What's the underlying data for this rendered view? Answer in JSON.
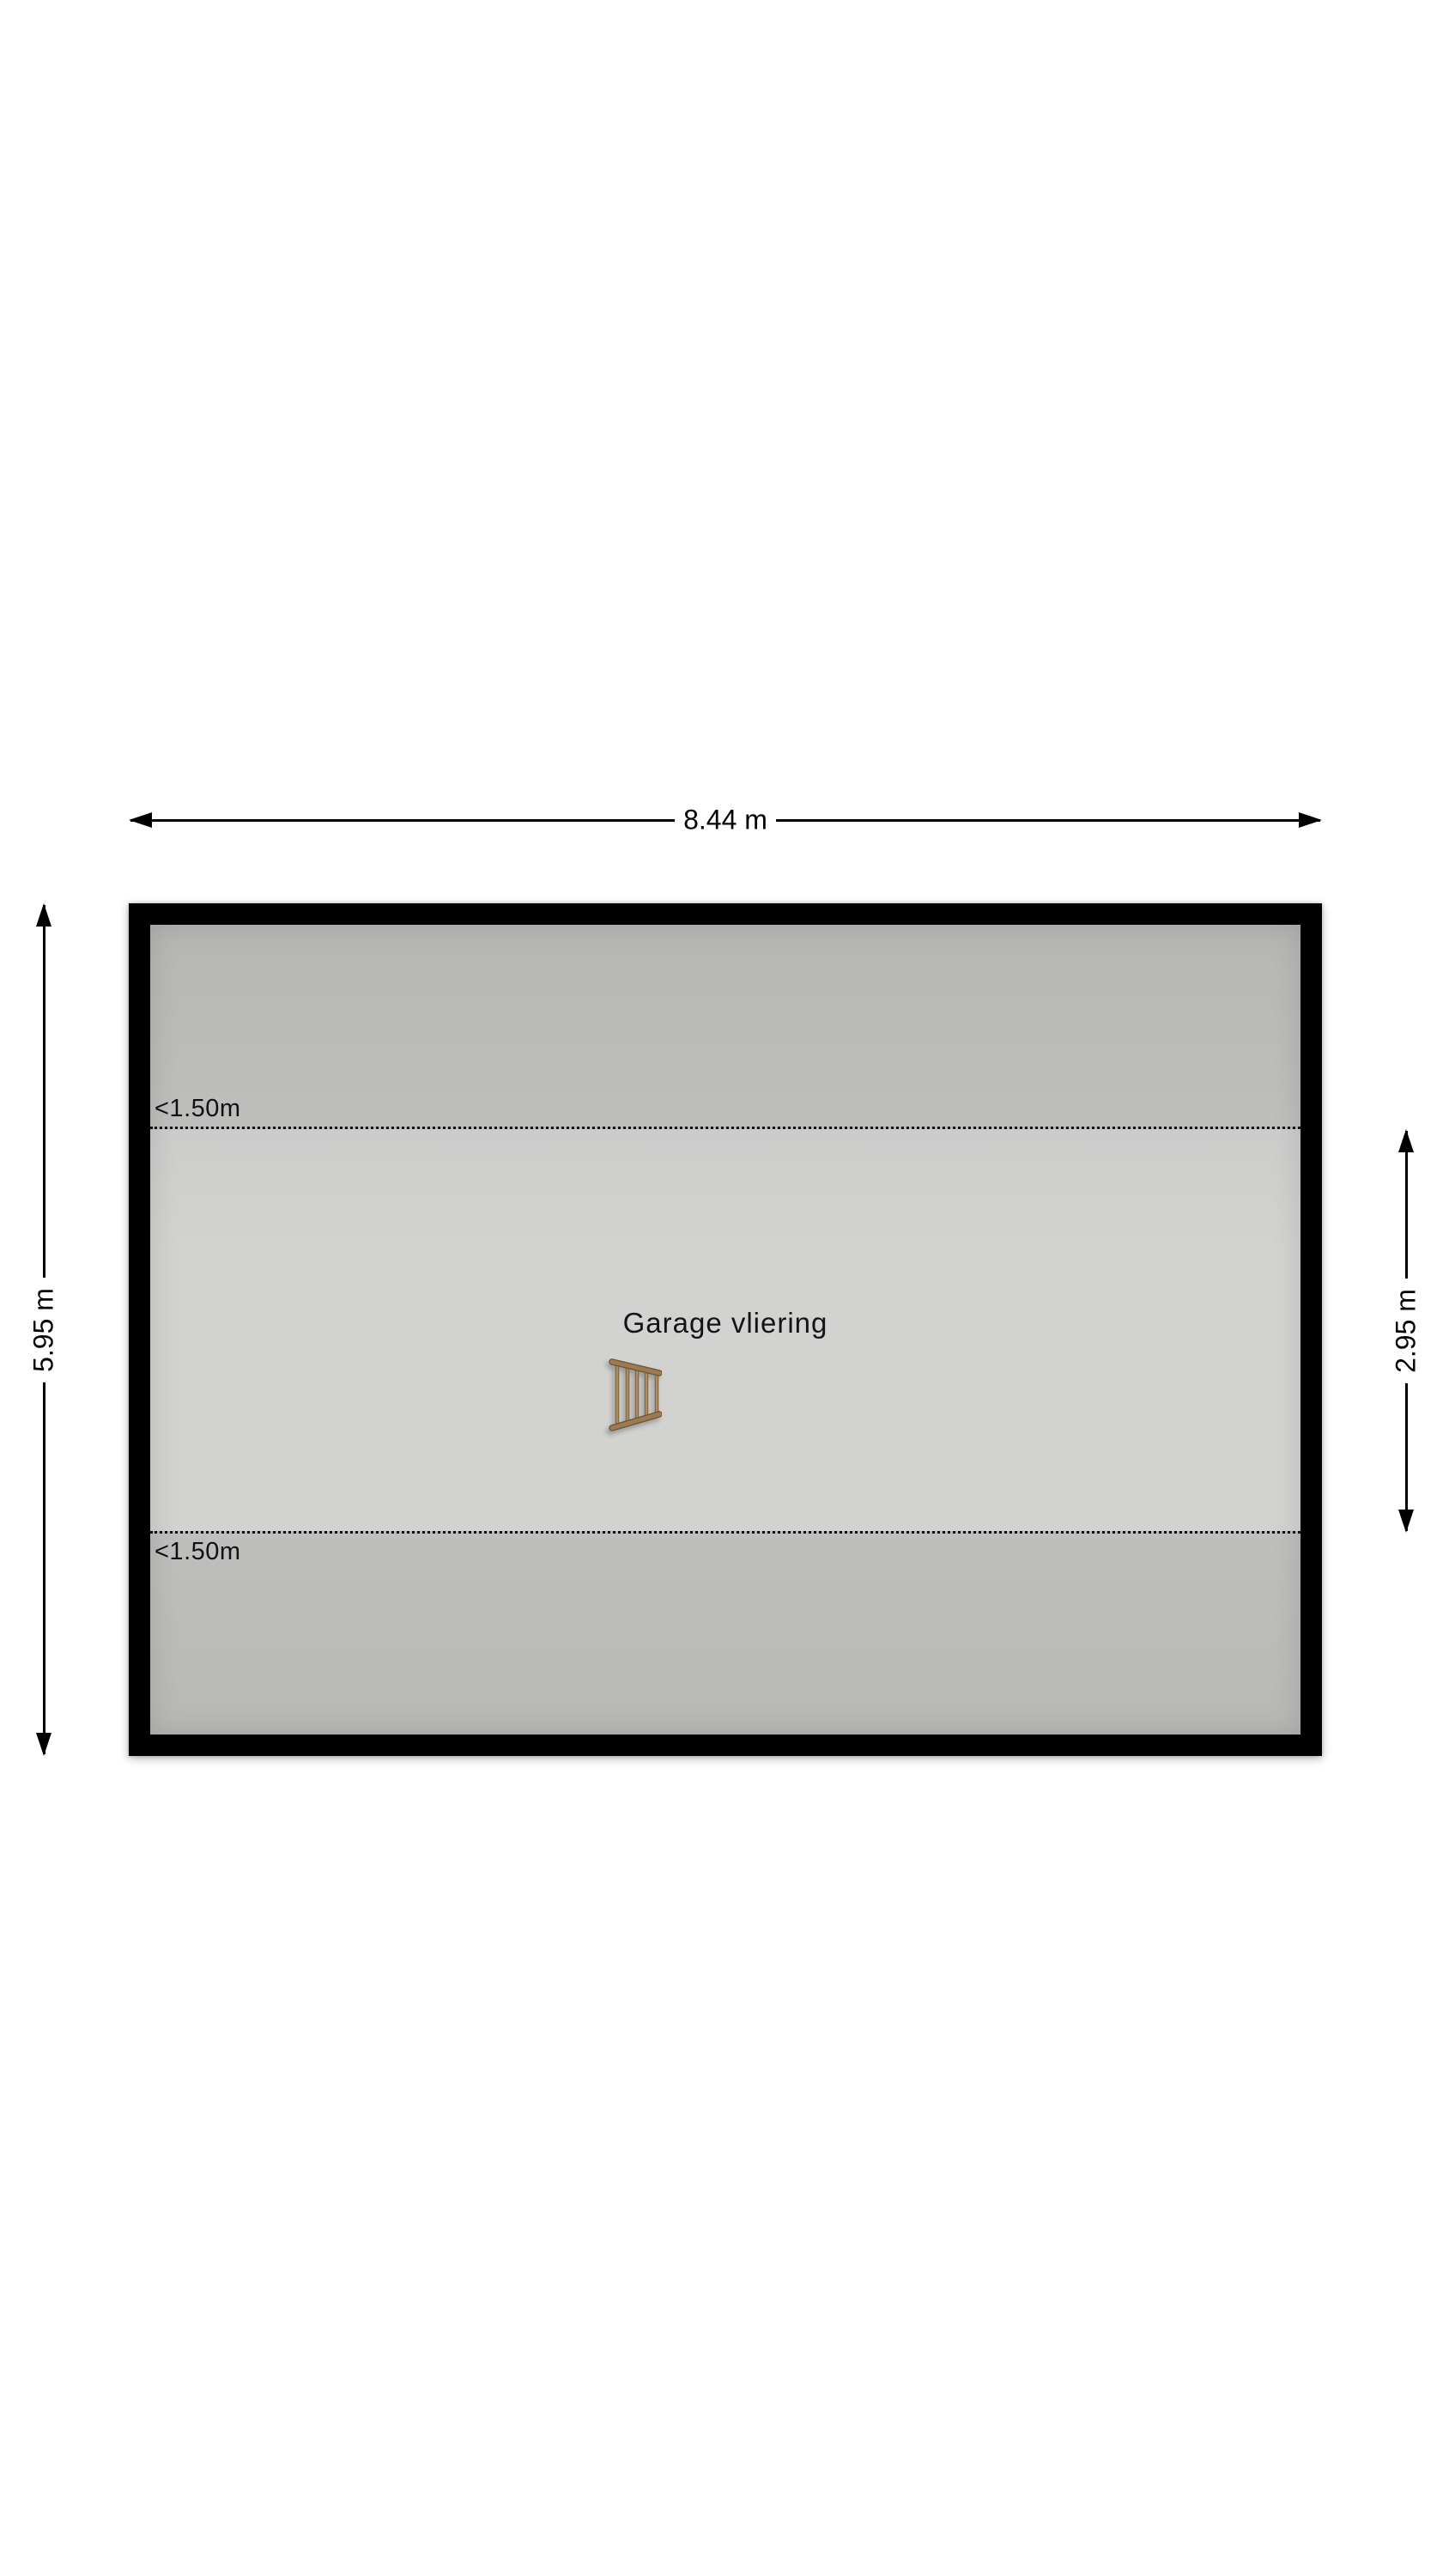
{
  "floorplan": {
    "room_label": "Garage vliering",
    "dimensions": {
      "total_width": "8.44 m",
      "total_depth": "5.95 m",
      "full_height_depth": "2.95 m"
    },
    "headroom": {
      "top": "<1.50m",
      "bottom": "<1.50m"
    },
    "icons": {
      "ladder": "loft-ladder-icon",
      "arrows": [
        "arrow-left-icon",
        "arrow-right-icon",
        "arrow-up-icon",
        "arrow-down-icon"
      ]
    },
    "colors": {
      "background": "#ffffff",
      "wall": "#000000",
      "low_headroom_zone": "#bebebc",
      "full_height_zone": "#d2d2d0",
      "ladder_wood": "#9c7b52"
    }
  }
}
